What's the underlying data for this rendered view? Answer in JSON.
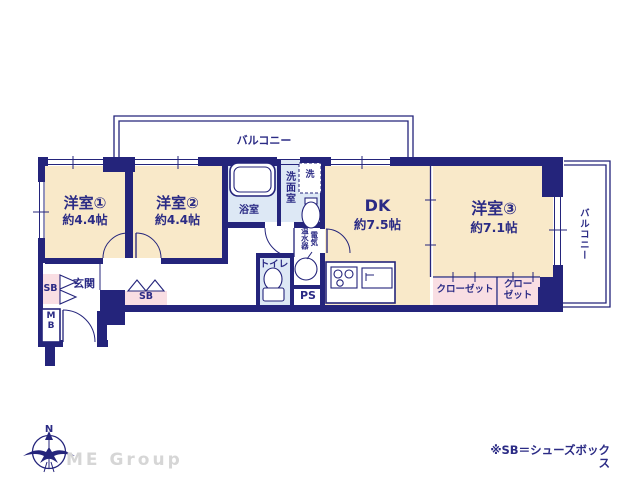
{
  "colors": {
    "navy": "#24247b",
    "ink": "#2b2b85",
    "cream": "#f9e9c9",
    "pink": "#f9dee3",
    "blue": "#dde8f5",
    "gray": "#d6d6d6",
    "white": "#ffffff"
  },
  "rooms": {
    "western1": {
      "name": "洋室①",
      "size": "約4.4帖"
    },
    "western2": {
      "name": "洋室②",
      "size": "約4.4帖"
    },
    "dk": {
      "name": "DK",
      "size": "約7.5帖"
    },
    "western3": {
      "name": "洋室③",
      "size": "約7.1帖"
    }
  },
  "labels": {
    "balcony_top": "バルコニー",
    "balcony_right": "バルコニー",
    "bathroom": "浴室",
    "washroom": "洗面室",
    "laundry": "洗",
    "water_heater": "電気\n温水器",
    "toilet": "トイレ",
    "pipe_space": "PS",
    "entrance": "玄関",
    "shoe_box_left": "SB",
    "shoe_box_right": "SB",
    "meter_box": "M\nB",
    "closet1": "クローゼット",
    "closet2": "クロー\nゼット"
  },
  "note": "※SB＝シューズボックス",
  "compass": {
    "north": "N"
  },
  "watermark": "ME Group"
}
